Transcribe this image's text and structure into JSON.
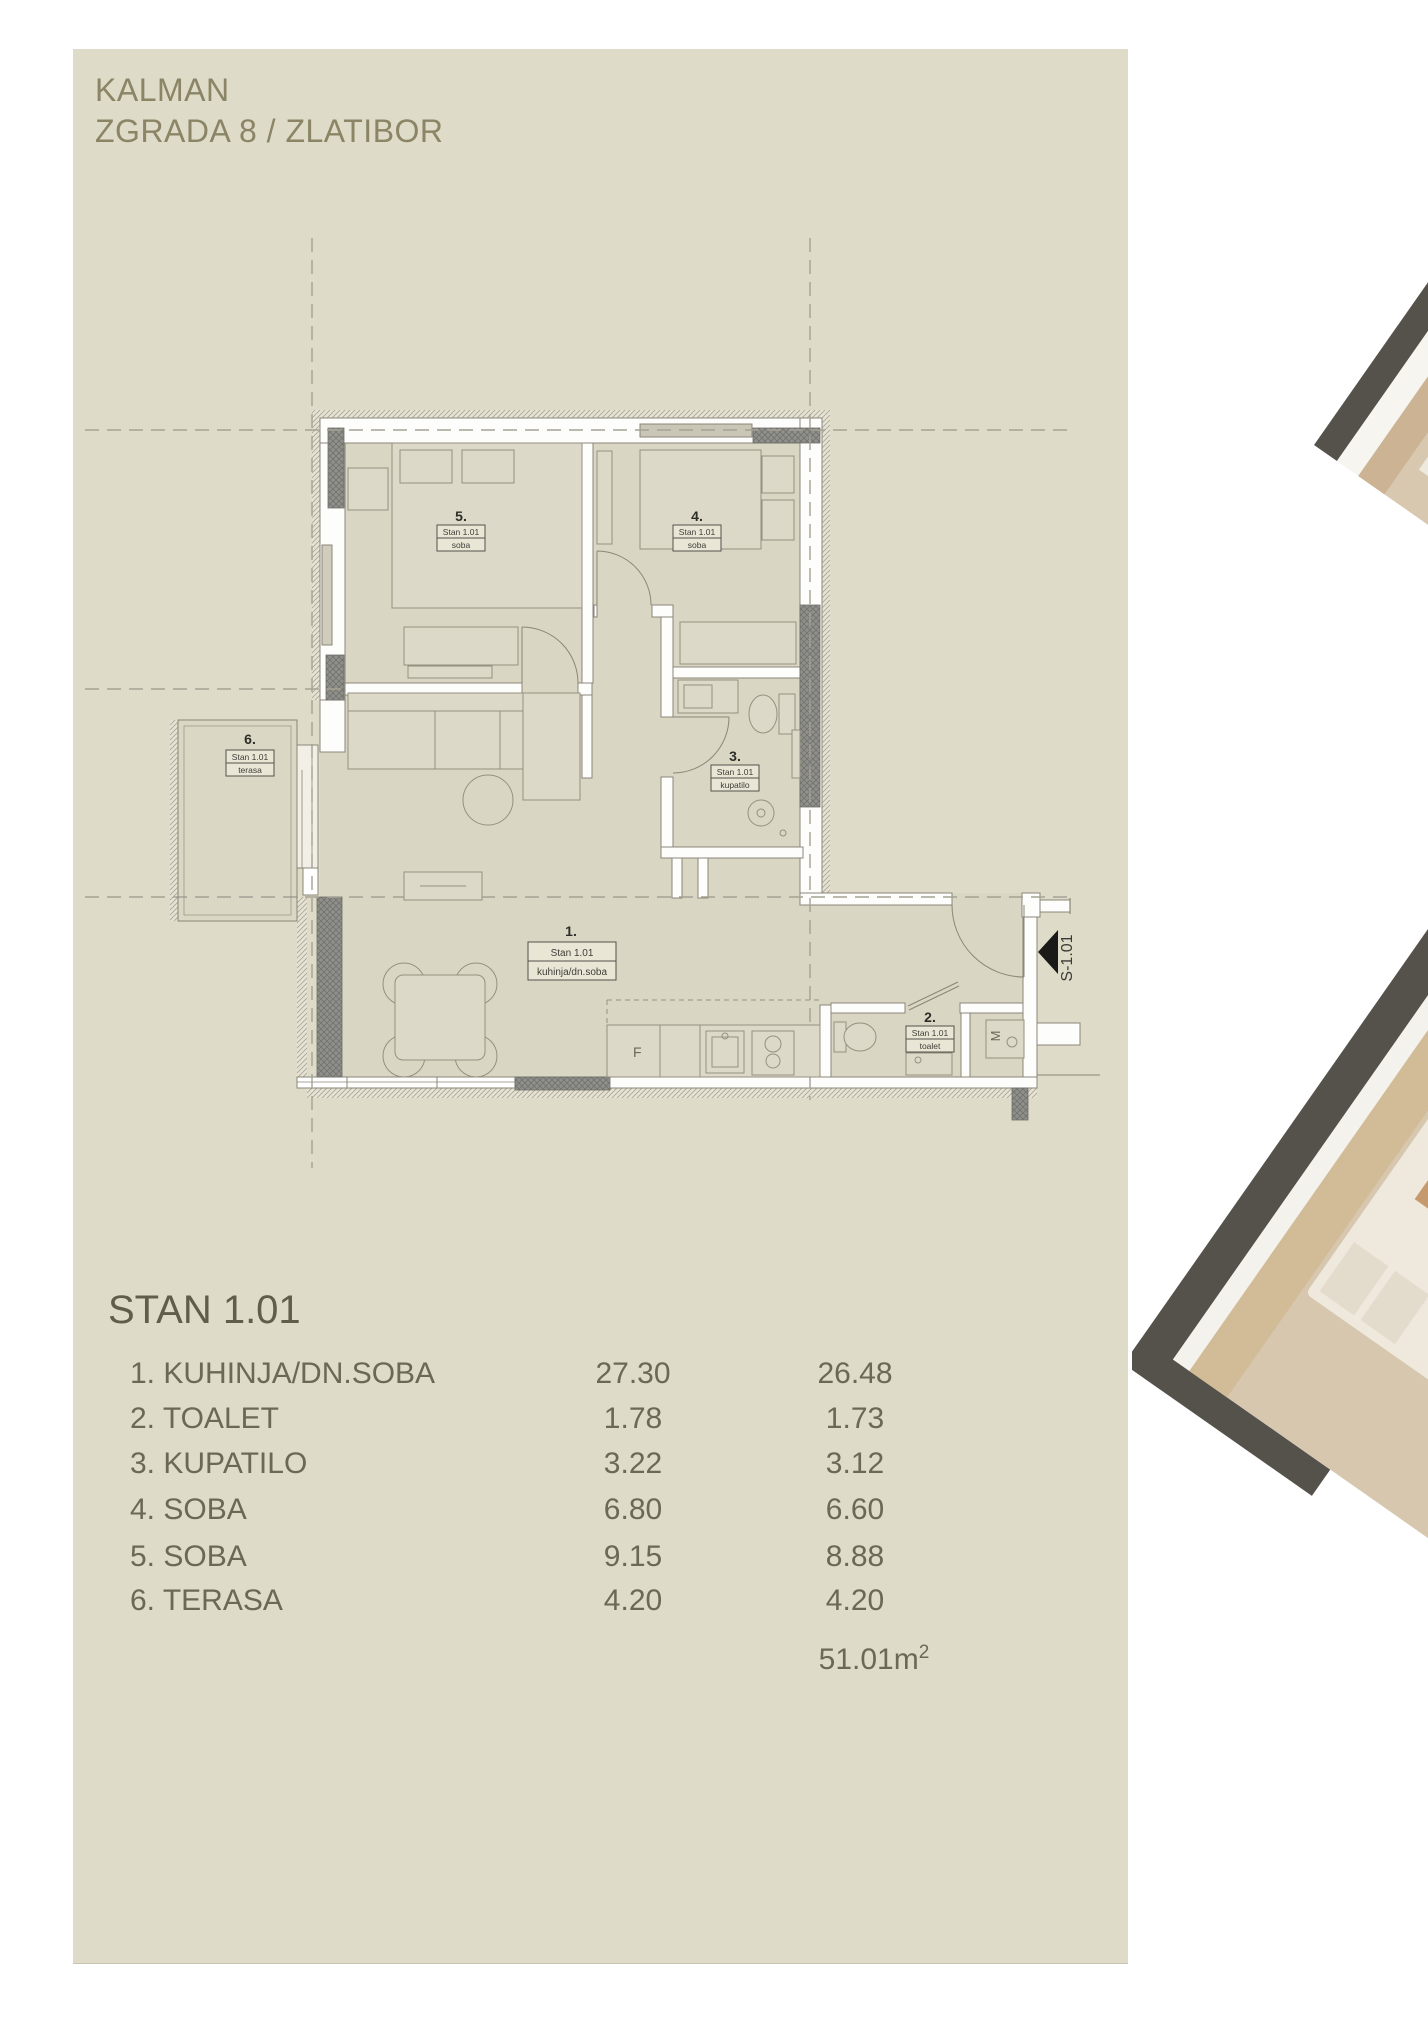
{
  "title": {
    "line1": "KALMAN",
    "line2": "ZGRADA 8 / ZLATIBOR"
  },
  "plan": {
    "rooms": [
      {
        "num": "1.",
        "unit": "Stan 1.01",
        "name": "kuhinja/dn.soba"
      },
      {
        "num": "2.",
        "unit": "Stan 1.01",
        "name": "toalet"
      },
      {
        "num": "3.",
        "unit": "Stan 1.01",
        "name": "kupatilo"
      },
      {
        "num": "4.",
        "unit": "Stan 1.01",
        "name": "soba"
      },
      {
        "num": "5.",
        "unit": "Stan 1.01",
        "name": "soba"
      },
      {
        "num": "6.",
        "unit": "Stan 1.01",
        "name": "terasa"
      }
    ],
    "markers": {
      "entrance": "S-1.01",
      "fridge": "F",
      "washer": "M"
    }
  },
  "table": {
    "heading": "STAN 1.01",
    "rows": [
      {
        "label": "1. KUHINJA/DN.SOBA",
        "area": "27.30",
        "reduced": "26.48"
      },
      {
        "label": "2. TOALET",
        "area": "1.78",
        "reduced": "1.73"
      },
      {
        "label": "3. KUPATILO",
        "area": "3.22",
        "reduced": "3.12"
      },
      {
        "label": "4. SOBA",
        "area": "6.80",
        "reduced": "6.60"
      },
      {
        "label": "5. SOBA",
        "area": "9.15",
        "reduced": "8.88"
      },
      {
        "label": "6. TERASA",
        "area": "4.20",
        "reduced": "4.20"
      }
    ],
    "total": "51.01m",
    "total_sup": "2"
  },
  "colors": {
    "card_bg": "#dedbc8",
    "title_text": "#8b8566",
    "table_text": "#6b6856",
    "plan_column_gray": "#8f8f8b",
    "render_wall": "#55514b",
    "marker_black": "#1a1a18"
  }
}
